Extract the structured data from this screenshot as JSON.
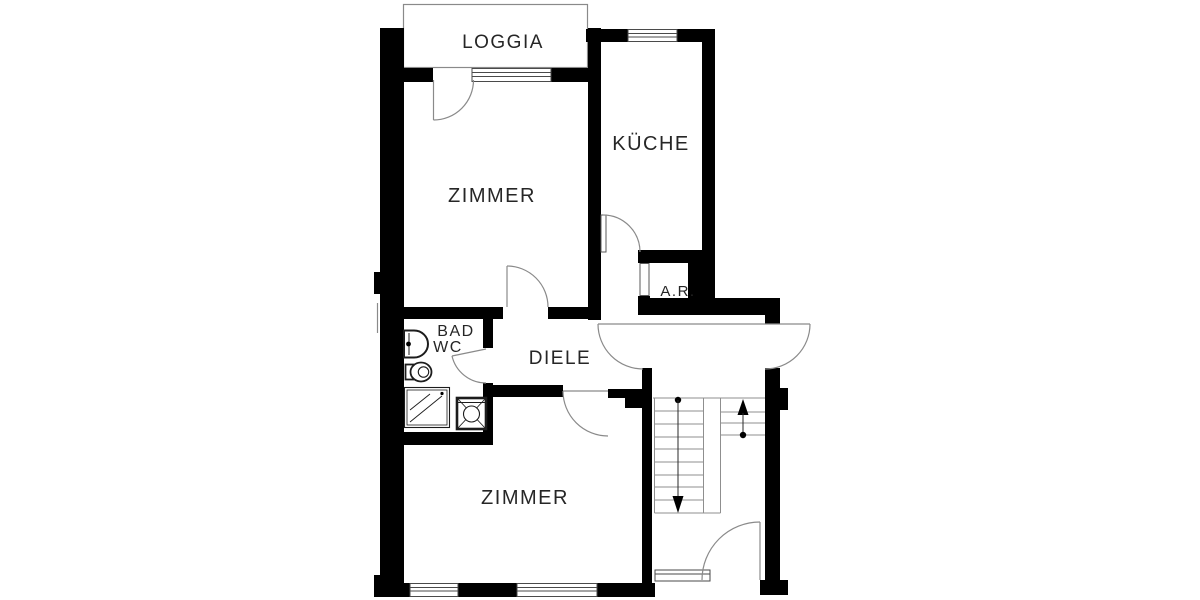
{
  "document": {
    "type": "apartment-floor-plan",
    "background": "#ffffff"
  },
  "colors": {
    "wall": "#000000",
    "thin_line": "#8a8a8a",
    "window_line": "#4a4a4a",
    "fixture_line": "#1c1c1c",
    "text": "#262626"
  },
  "rooms": [
    {
      "id": "loggia",
      "label": "LOGGIA"
    },
    {
      "id": "zimmer-top",
      "label": "ZIMMER"
    },
    {
      "id": "kueche",
      "label": "KÜCHE"
    },
    {
      "id": "abstellraum",
      "label": "A.R."
    },
    {
      "id": "bad",
      "label": "BAD"
    },
    {
      "id": "wc",
      "label": "WC"
    },
    {
      "id": "diele",
      "label": "DIELE"
    },
    {
      "id": "zimmer-bottom",
      "label": "ZIMMER"
    }
  ],
  "fixtures": [
    {
      "id": "sink",
      "name": "washbasin"
    },
    {
      "id": "toilet",
      "name": "wc-toilet"
    },
    {
      "id": "shower",
      "name": "shower-tray"
    },
    {
      "id": "washing-machine",
      "name": "washing-machine"
    }
  ],
  "stairs": {
    "flight_down_marker": "down-arrow",
    "flight_up_marker": "up-arrow",
    "left_flight_treads": 9,
    "right_flight_treads": 3
  },
  "windows": {
    "count": 5,
    "positions": [
      "loggia-wall",
      "kitchen-top-wall",
      "bottom-wall-left",
      "bottom-wall-right",
      "stairwell-bottom"
    ]
  },
  "doors": {
    "count": 9,
    "positions": [
      "zimmer-top-to-loggia",
      "kueche",
      "zimmer-top",
      "bad",
      "apartment-entry",
      "neighbor-entry",
      "zimmer-bottom",
      "abstellraum",
      "building-entry"
    ]
  }
}
